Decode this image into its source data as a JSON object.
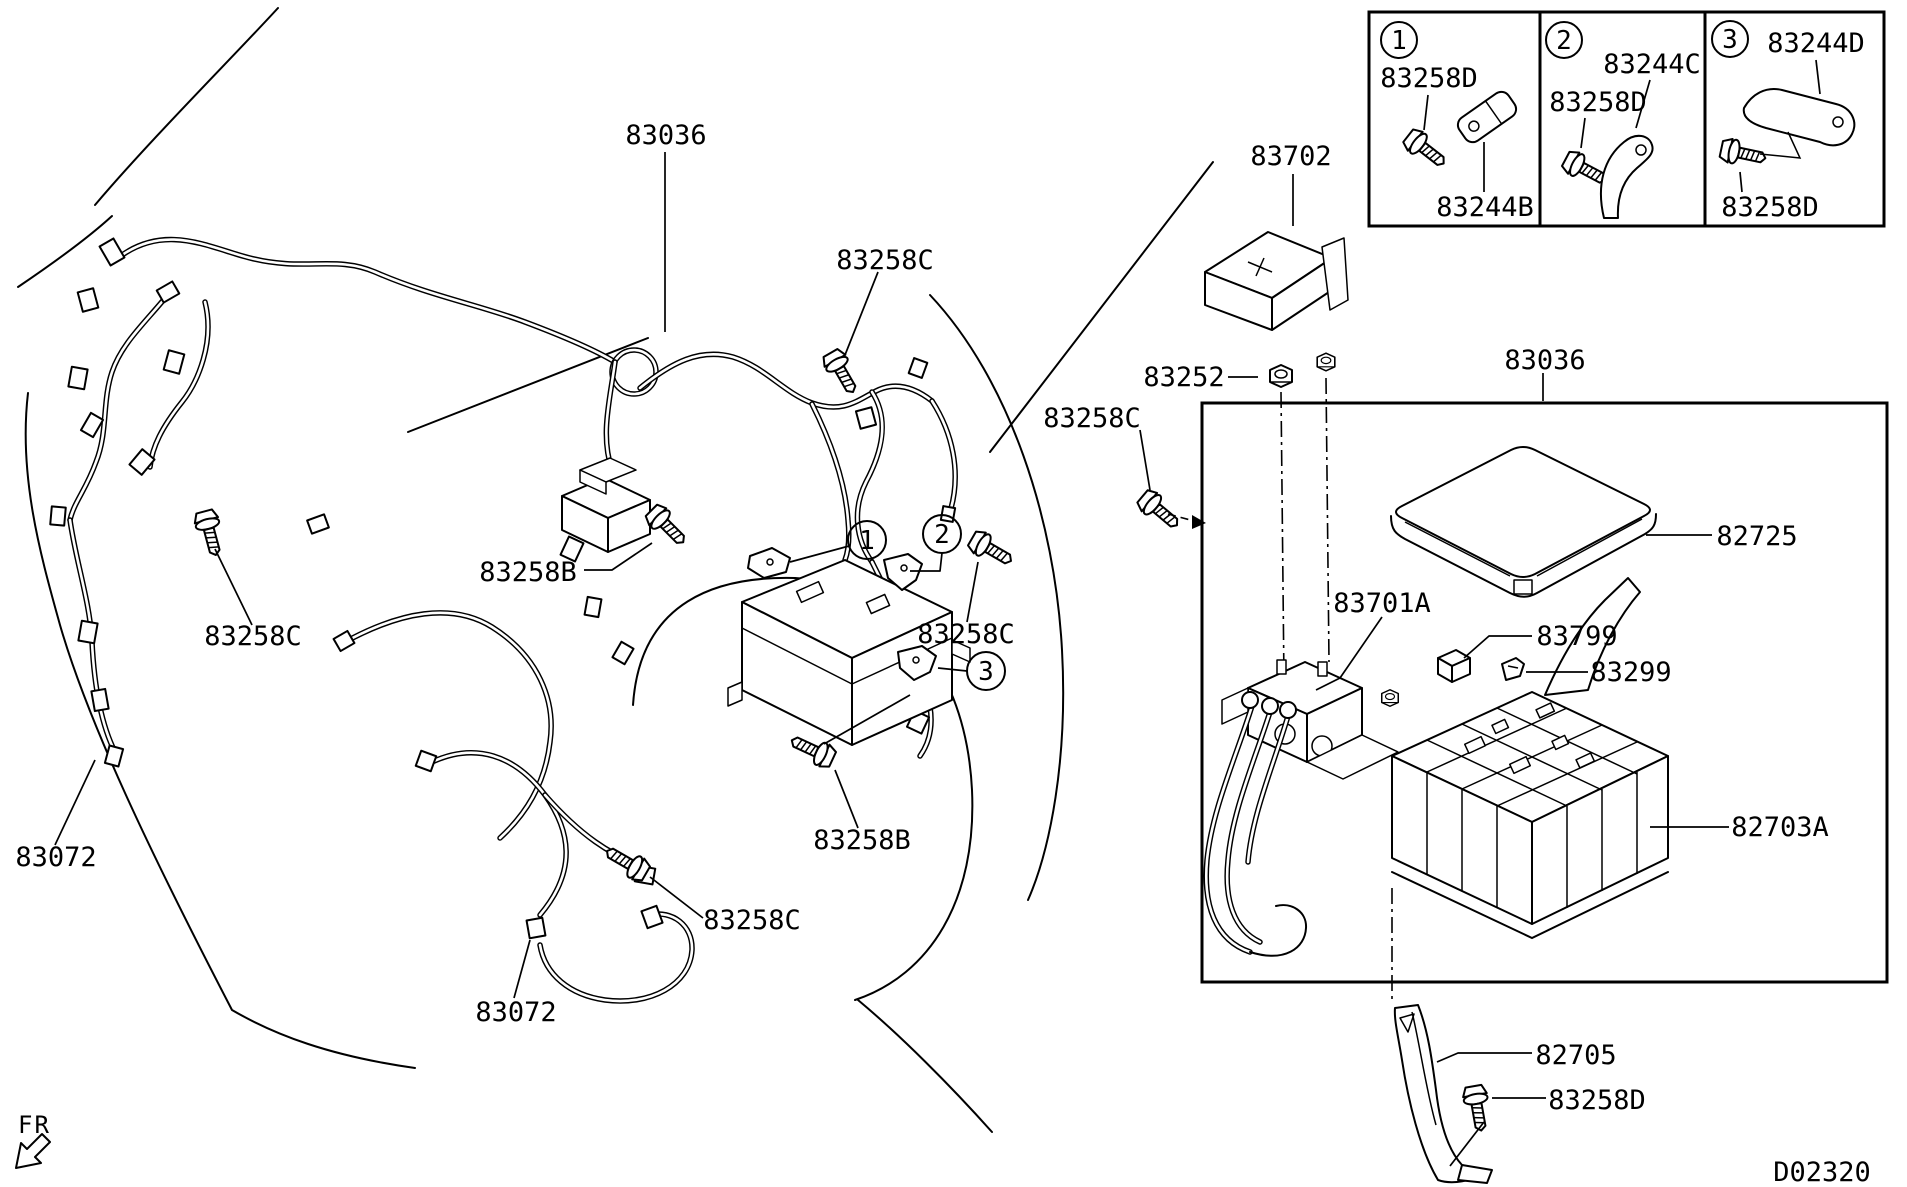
{
  "footer": {
    "code": "D02320",
    "front_marker": "FR"
  },
  "colors": {
    "ink": "#000000",
    "paper": "#ffffff"
  },
  "part_labels": {
    "harness_top": "83036",
    "harness_inset": "83036",
    "bolt_top_c": "83258C",
    "bolt_left_b": "83258B",
    "bolt_left_c": "83258C",
    "harness_left": "83072",
    "bolt_mid_c": "83258C",
    "bolt_lower_b": "83258B",
    "bolt_lower_c": "83258C",
    "harness_lower": "83072",
    "battery_cover": "83702",
    "battery_nut": "83252",
    "bolt_right_c": "83258C",
    "fusebox_cover": "82725",
    "terminal_block": "83701A",
    "relay_clip": "83799",
    "harness_clip": "83299",
    "fusebox": "82703A",
    "support_bracket": "82705",
    "bracket_bolt_d": "83258D"
  },
  "callouts": {
    "one": "1",
    "two": "2",
    "three": "3"
  },
  "insets": [
    {
      "number": "1",
      "part_a": "83258D",
      "part_b": "83244B"
    },
    {
      "number": "2",
      "part_a": "83244C",
      "part_b": "83258D"
    },
    {
      "number": "3",
      "part_a": "83244D",
      "part_b": "83258D"
    }
  ]
}
